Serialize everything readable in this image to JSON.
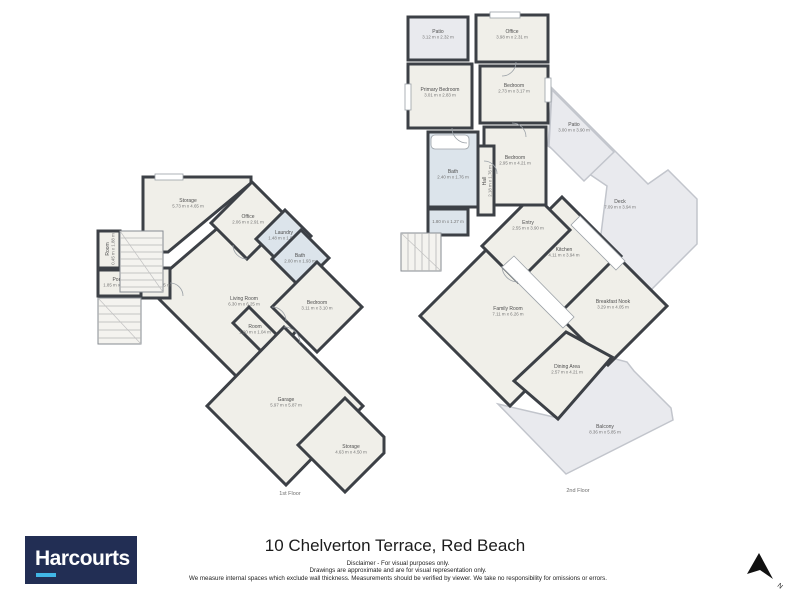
{
  "page": {
    "address": "10 Chelverton Terrace, Red Beach"
  },
  "logo": {
    "text": "Harcourts",
    "bg": "#222e54",
    "underline": "#41b6e6"
  },
  "disclaimer": [
    "Disclaimer - For visual purposes only.",
    "Drawings are approximate and are for visual representation only.",
    "We measure internal spaces which exclude wall thickness. Measurements should be verified by viewer. We take no responsibility for omissions or errors."
  ],
  "north": {
    "points": "759,553 747,574 760,570 773,579",
    "label": "N",
    "lx": 777,
    "ly": 586,
    "rotate": 40
  },
  "palette": {
    "label_name": "#4f4f4f",
    "label_dims": "#757575",
    "caption": "#6e6e6e",
    "fixture": "#9aa0a6",
    "types": {
      "interior": {
        "fill": "#f0efe9",
        "stroke": "#3c4046",
        "sw": 3
      },
      "wet": {
        "fill": "#dce4eb",
        "stroke": "#3c4046",
        "sw": 3
      },
      "outdoor": {
        "fill": "#e9eaee",
        "stroke": "#c2c5cc",
        "sw": 1.5
      },
      "outdoor_dark": {
        "fill": "#e9eaee",
        "stroke": "#3c4046",
        "sw": 3
      }
    }
  },
  "floors": [
    {
      "name": "floor-plan-1st",
      "caption": "1st Floor",
      "cx": 290,
      "cy": 495,
      "rooms": [
        {
          "id": "living-room-1f",
          "type": "interior",
          "pts": "234,214 320,300 250,390 148,288",
          "lx": 244,
          "ly": 300,
          "room_name": "Living Room",
          "dims": "6.30 m x 6.25 m"
        },
        {
          "id": "storage-top-1f",
          "type": "interior",
          "pts": "143,177 251,177 251,183 168,252 143,252",
          "lx": 188,
          "ly": 202,
          "room_name": "Storage",
          "dims": "5.73 m x 4.65 m"
        },
        {
          "id": "office-1f",
          "type": "interior",
          "pts": "252,182 288,218 247,259 211,223",
          "lx": 248,
          "ly": 218,
          "room_name": "Office",
          "dims": "2.06 m x 2.91 m"
        },
        {
          "id": "laundry-1f",
          "type": "wet",
          "pts": "285,210 311,236 282,265 256,239",
          "lx": 284,
          "ly": 234,
          "room_name": "Laundry",
          "dims": "1.48 m x 1.98 m"
        },
        {
          "id": "bath-1f",
          "type": "wet",
          "pts": "301,230 329,258 300,287 272,259",
          "lx": 300,
          "ly": 257,
          "room_name": "Bath",
          "dims": "2.00 m x 1.93 m"
        },
        {
          "id": "bedroom-1f",
          "type": "interior",
          "pts": "317,262 362,307 317,352 272,307",
          "lx": 317,
          "ly": 304,
          "room_name": "Bedroom",
          "dims": "3.11 m x 3.10 m"
        },
        {
          "id": "room-nook-1f",
          "type": "interior",
          "pts": "249,307 277,335 261,351 233,323",
          "lx": 255,
          "ly": 328,
          "room_name": "Room",
          "dims": "1.90 m x 1.04 m"
        },
        {
          "id": "garage-1f",
          "type": "interior",
          "pts": "284,327 363,406 286,485 207,406",
          "lx": 286,
          "ly": 401,
          "room_name": "Garage",
          "dims": "5.97 m x 5.87 m"
        },
        {
          "id": "storage-bottom-1f",
          "type": "interior",
          "pts": "345,398 384,437 384,453 345,492 298,445",
          "lx": 351,
          "ly": 448,
          "room_name": "Storage",
          "dims": "4.63 m x 4.50 m"
        },
        {
          "id": "room-strip-1f",
          "type": "interior",
          "pts": "98,231 120,231 120,268 98,268",
          "lx": 109,
          "ly": 249,
          "room_name": "Room",
          "dims": "0.45 m x 1.88 m",
          "vert": true
        },
        {
          "id": "porch-1f",
          "type": "interior",
          "pts": "98,270 141,270 141,296 98,296",
          "lx": 119,
          "ly": 281,
          "room_name": "Porch",
          "dims": "1.85 m x 1.10 m"
        },
        {
          "id": "hall-1f",
          "type": "interior",
          "pts": "141,268 170,268 170,298 141,298",
          "lx": 155,
          "ly": 281,
          "room_name": "Hall",
          "dims": "1.04 m x 0.75 m"
        }
      ],
      "features": [
        {
          "kind": "stairs",
          "x": 120,
          "y": 231,
          "w": 43,
          "h": 61,
          "step": 7,
          "dir": "h"
        },
        {
          "kind": "stairs",
          "x": 98,
          "y": 298,
          "w": 43,
          "h": 46,
          "step": 8,
          "dir": "h"
        },
        {
          "kind": "rect",
          "x": 155,
          "y": 174,
          "w": 28,
          "h": 6
        },
        {
          "kind": "path",
          "d": "M247,259 A14,14 0 0 1 233,245"
        },
        {
          "kind": "path",
          "d": "M272,307 A14,14 0 0 1 286,321"
        },
        {
          "kind": "path",
          "d": "M170,283 A13,13 0 0 1 183,296"
        },
        {
          "kind": "path",
          "d": "M300,343 A16,16 0 0 0 284,327"
        }
      ]
    },
    {
      "name": "floor-plan-2nd",
      "caption": "2nd Floor",
      "cx": 578,
      "cy": 492,
      "rooms": [
        {
          "id": "deck-2f",
          "type": "outdoor",
          "pts": "552,88 648,184 668,170 697,199 697,244 636,305 597,266 607,186 548,146",
          "lx": 620,
          "ly": 203,
          "room_name": "Deck",
          "dims": "7.09 m x 3.94 m"
        },
        {
          "id": "patio-right-2f",
          "type": "outdoor",
          "pts": "552,90 614,152 584,181 549,146",
          "lx": 574,
          "ly": 126,
          "room_name": "Patio",
          "dims": "3.00 m x 3.90 m"
        },
        {
          "id": "patio-topleft-2f",
          "type": "outdoor_dark",
          "pts": "408,17 468,17 468,60 408,60",
          "lx": 438,
          "ly": 33,
          "room_name": "Patio",
          "dims": "3.12 m x 2.32 m"
        },
        {
          "id": "balcony-2f",
          "type": "outdoor",
          "pts": "498,404 558,418 612,358 627,362 634,371 671,408 673,420 566,474",
          "lx": 605,
          "ly": 428,
          "room_name": "Balcony",
          "dims": "8.36 m x 5.85 m"
        },
        {
          "id": "family-room-2f",
          "type": "interior",
          "pts": "508,228 598,318 510,406 420,316",
          "lx": 508,
          "ly": 310,
          "room_name": "Family Room",
          "dims": "7.11 m x 6.26 m"
        },
        {
          "id": "kitchen-2f",
          "type": "interior",
          "pts": "562,197 621,256 564,313 505,254",
          "lx": 564,
          "ly": 251,
          "room_name": "Kitchen",
          "dims": "4.11 m x 3.94 m"
        },
        {
          "id": "breakfast-nook-2f",
          "type": "interior",
          "pts": "617,256 667,306 608,365 558,315",
          "lx": 613,
          "ly": 303,
          "room_name": "Breakfast Nook",
          "dims": "3.29 m x 4.05 m"
        },
        {
          "id": "dining-area-2f",
          "type": "interior",
          "pts": "566,332 612,357 558,419 514,381",
          "lx": 567,
          "ly": 368,
          "room_name": "Dining Area",
          "dims": "2.57 m x 4.21 m"
        },
        {
          "id": "entry-2f",
          "type": "interior",
          "pts": "534,194 570,230 518,282 482,246",
          "lx": 528,
          "ly": 224,
          "room_name": "Entry",
          "dims": "2.55 m x 3.90 m"
        },
        {
          "id": "office-2f",
          "type": "interior",
          "pts": "476,15 548,15 548,62 476,62",
          "lx": 512,
          "ly": 33,
          "room_name": "Office",
          "dims": "3.98 m x 2.31 m"
        },
        {
          "id": "primary-bedroom-2f",
          "type": "interior",
          "pts": "408,64 472,64 472,128 408,128",
          "lx": 440,
          "ly": 91,
          "room_name": "Primary Bedroom",
          "dims": "3.01 m x 2.83 m"
        },
        {
          "id": "bedroom-topright-2f",
          "type": "interior",
          "pts": "480,66 548,66 548,123 480,123",
          "lx": 514,
          "ly": 87,
          "room_name": "Bedroom",
          "dims": "2.73 m x 3.17 m"
        },
        {
          "id": "bedroom-mid-2f",
          "type": "interior",
          "pts": "484,127 546,127 546,205 484,205",
          "lx": 515,
          "ly": 159,
          "room_name": "Bedroom",
          "dims": "2.95 m x 4.21 m"
        },
        {
          "id": "bath-2f",
          "type": "wet",
          "pts": "428,132 478,132 478,207 428,207",
          "lx": 453,
          "ly": 173,
          "room_name": "Bath",
          "dims": "2.40 m x 1.76 m"
        },
        {
          "id": "hall-2f",
          "type": "interior",
          "pts": "478,146 494,146 494,215 478,215",
          "lx": 486,
          "ly": 181,
          "room_name": "Hall",
          "dims": "2.18 m x 1.76 m",
          "vert": true
        },
        {
          "id": "wc-2f",
          "type": "wet",
          "pts": "428,209 468,209 468,235 428,235",
          "lx": 448,
          "ly": 223,
          "room_name": "",
          "dims": "1.80 m x 1.27 m"
        }
      ],
      "features": [
        {
          "kind": "stairs",
          "x": 401,
          "y": 233,
          "w": 40,
          "h": 38,
          "step": 7,
          "dir": "v"
        },
        {
          "kind": "poly",
          "pts": "563,328 574,317 514,256 502,267"
        },
        {
          "kind": "poly",
          "pts": "616,270 625,261 580,216 571,225"
        },
        {
          "kind": "rect",
          "x": 431,
          "y": 135,
          "w": 38,
          "h": 14,
          "rx": 4
        },
        {
          "kind": "rect",
          "x": 490,
          "y": 12,
          "w": 30,
          "h": 6
        },
        {
          "kind": "rect",
          "x": 405,
          "y": 84,
          "w": 6,
          "h": 26
        },
        {
          "kind": "rect",
          "x": 545,
          "y": 78,
          "w": 6,
          "h": 24
        },
        {
          "kind": "path",
          "d": "M516,62 A14,14 0 0 1 502,76"
        },
        {
          "kind": "path",
          "d": "M452,128 A15,15 0 0 0 467,143"
        },
        {
          "kind": "path",
          "d": "M512,123 A14,14 0 0 1 526,137"
        },
        {
          "kind": "path",
          "d": "M484,161 A13,13 0 0 1 497,174"
        },
        {
          "kind": "path",
          "d": "M518,282 A16,16 0 0 1 502,266"
        }
      ]
    }
  ]
}
